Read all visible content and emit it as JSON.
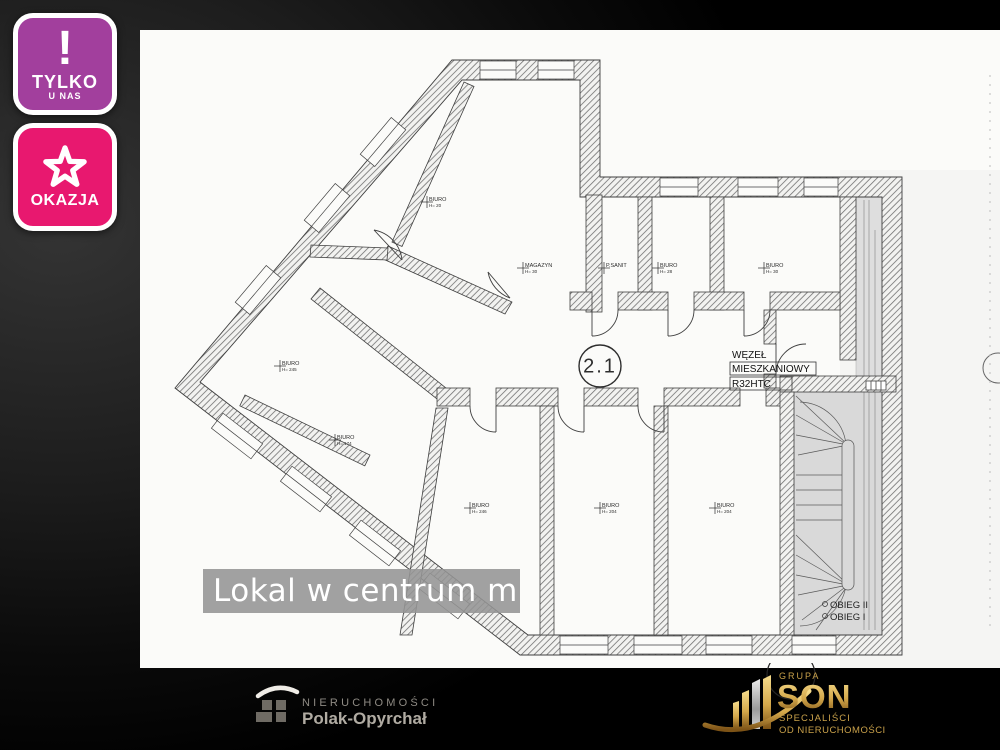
{
  "badges": {
    "tylko": {
      "icon": "!",
      "line1": "TYLKO",
      "line2": "U NAS",
      "bg": "#a23f9d"
    },
    "okazja": {
      "label": "OKAZJA",
      "bg": "#e8186f"
    }
  },
  "caption": {
    "text": "Lokal w centrum miasta",
    "bg": "#949494"
  },
  "floorplan": {
    "unit_circle_label": "2.1",
    "node": {
      "line1": "WĘZEŁ",
      "line2": "MIESZKANIOWY",
      "line3": "R32HTC"
    },
    "stairs": {
      "flight2": "OBIEG II",
      "flight1": "OBIEG I"
    },
    "rooms": [
      {
        "name": "BIURO",
        "sub": "H= 20"
      },
      {
        "name": "MAGAZYN",
        "sub": "H= 30"
      },
      {
        "name": "P.SANIT",
        "sub": ""
      },
      {
        "name": "BIURO",
        "sub": "H= 28"
      },
      {
        "name": "BIURO",
        "sub": "H= 30"
      },
      {
        "name": "BIURO",
        "sub": "H= 245"
      },
      {
        "name": "BIURO",
        "sub": "H= 174"
      },
      {
        "name": "BIURO",
        "sub": "H= 246"
      },
      {
        "name": "BIURO",
        "sub": "H= 204"
      },
      {
        "name": "BIURO",
        "sub": "H= 204"
      }
    ]
  },
  "footer": {
    "agency": {
      "line1": "NIERUCHOMOŚCI",
      "line2": "Polak-Opyrchał"
    },
    "group": {
      "top": "GRUPA",
      "name": "SON",
      "sub1": "SPECJALIŚCI",
      "sub2": "OD NIERUCHOMOŚCI",
      "gold": "#c9a14a"
    }
  }
}
